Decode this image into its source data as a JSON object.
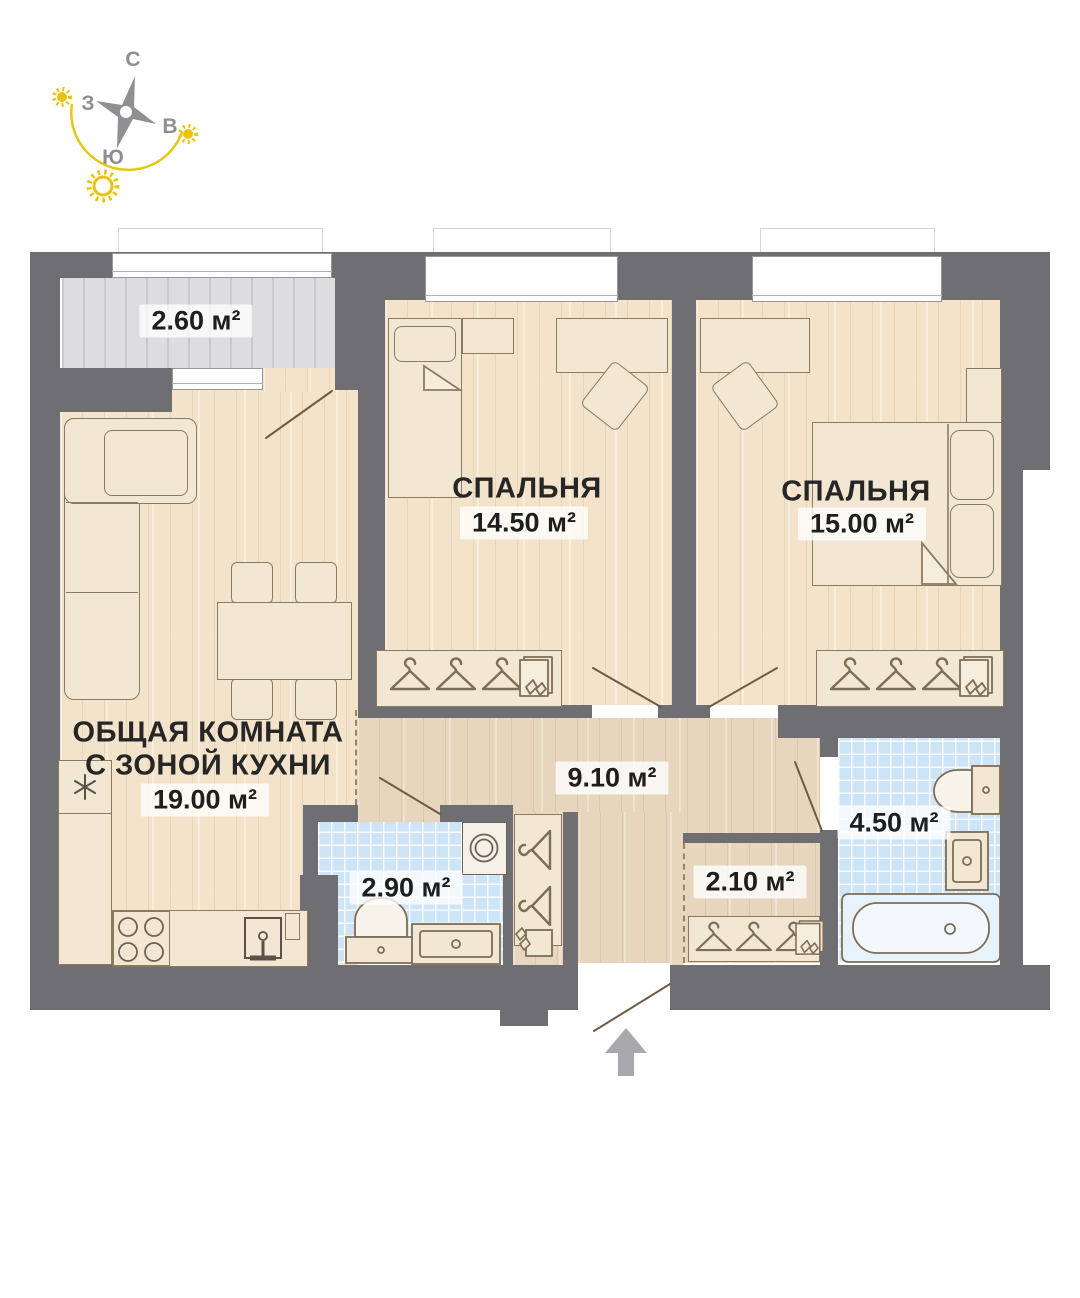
{
  "compass": {
    "north": "С",
    "south": "Ю",
    "east": "В",
    "west": "З"
  },
  "rooms": {
    "balcony": {
      "area": "2.60 м²"
    },
    "bedroom_1": {
      "name": "СПАЛЬНЯ",
      "area": "14.50 м²"
    },
    "bedroom_2": {
      "name": "СПАЛЬНЯ",
      "area": "15.00 м²"
    },
    "living_kitchen": {
      "name_line_1": "ОБЩАЯ КОМНАТА",
      "name_line_2": "С ЗОНОЙ КУХНИ",
      "area": "19.00 м²"
    },
    "hallway": {
      "area": "9.10 м²"
    },
    "bathroom_small": {
      "area": "2.90 м²"
    },
    "wardrobe_room": {
      "area": "2.10 м²"
    },
    "bathroom_large": {
      "area": "4.50 м²"
    }
  },
  "colors": {
    "wall": "#6e6e73",
    "room_floor": "#f2e3ca",
    "hall_floor": "#e7d6bd",
    "balcony_floor": "#dddde0",
    "bathroom_tile": "#cde5f7",
    "furniture_outline": "#8b7a60",
    "sun_accent": "#e6c812",
    "label_text": "#1e1e1e"
  }
}
